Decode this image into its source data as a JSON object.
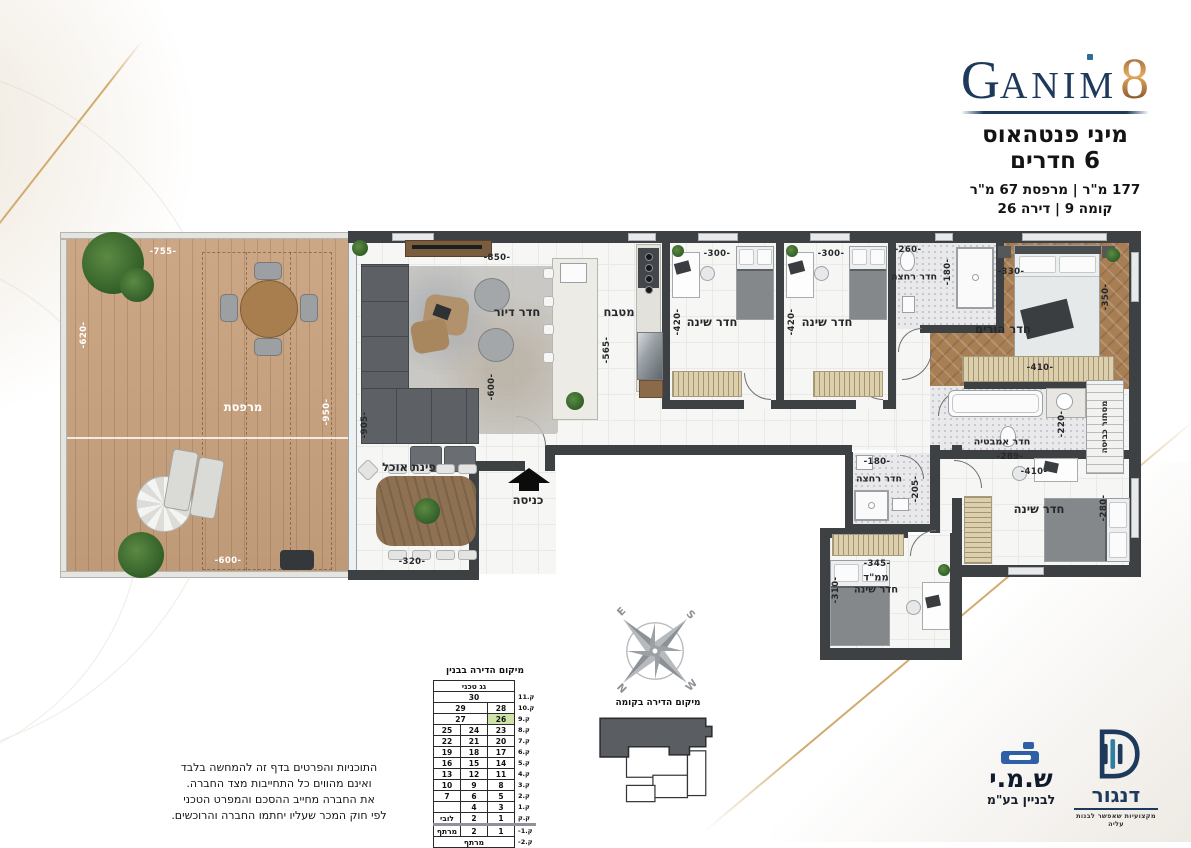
{
  "colors": {
    "brand_navy": "#1d3a5c",
    "brand_bronze": "#c08744",
    "accent_teal": "#2f6e94",
    "wall": "#3e4144",
    "deck_wood": "#c9a27e",
    "highlight_green": "#cfe3a9"
  },
  "header": {
    "brand_g": "G",
    "brand_rest": "ANIM",
    "brand_num": "8",
    "title_line1": "מיני פנטהאוס",
    "title_line2": "6 חדרים",
    "spec_line": "177 מ\"ר | מרפסת 67 מ\"ר",
    "floor_line": "קומה 9 | דירה 26"
  },
  "plan": {
    "labels": {
      "balcony": "מרפסת",
      "balcony_top": "-755-",
      "balcony_left": "-620-",
      "balcony_right": "-950-",
      "balcony_bottom": "-600-",
      "living": "חדר דיור",
      "living_top": "-850-",
      "living_right": "-905-",
      "living_mid": "-600-",
      "dining": "פינת אוכל",
      "dining_w": "-320-",
      "entrance": "כניסה",
      "kitchen": "מטבח",
      "kitchen_h": "-565-",
      "bedroom1": "חדר שינה",
      "bedroom1_w": "-300-",
      "bedroom1_h": "-420-",
      "bedroom2": "חדר שינה",
      "bedroom2_w": "-300-",
      "bedroom2_h": "-420-",
      "bath_top": "חדר רחצה",
      "bath_top_w": "-260-",
      "bath_top_h": "-180-",
      "master": "חדר הורים",
      "master_w": "-330-",
      "master_h": "-350-",
      "master_wardrobe": "-410-",
      "master_bath": "חדר אמבטיה",
      "master_bath_w": "-289-",
      "master_bath_h": "-220-",
      "laundry": "מסתור כביסה",
      "bath2": "חדר רחצה",
      "bath2_w": "-180-",
      "bath2_h": "-205-",
      "bedroom3": "חדר שינה",
      "bedroom3_w": "-410-",
      "bedroom3_h": "-280-",
      "mamad1": "ממ\"ד",
      "mamad2": "חדר שינה",
      "mamad_w": "-345-",
      "mamad_h": "-310-"
    }
  },
  "location_table": {
    "title": "מיקום הדירה בבנין",
    "floors": [
      {
        "label": "",
        "cells": [
          {
            "t": "גג טכני",
            "span": 3
          }
        ]
      },
      {
        "label": "11.ק",
        "cells": [
          {
            "t": "30",
            "span": 3
          }
        ]
      },
      {
        "label": "10.ק",
        "cells": [
          {
            "t": "29",
            "span": 2
          },
          {
            "t": "28"
          }
        ]
      },
      {
        "label": "9.ק",
        "cells": [
          {
            "t": "27",
            "span": 2
          },
          {
            "t": "26",
            "hl": true
          }
        ]
      },
      {
        "label": "8.ק",
        "cells": [
          {
            "t": "25"
          },
          {
            "t": "24"
          },
          {
            "t": "23"
          }
        ]
      },
      {
        "label": "7.ק",
        "cells": [
          {
            "t": "22"
          },
          {
            "t": "21"
          },
          {
            "t": "20"
          }
        ]
      },
      {
        "label": "6.ק",
        "cells": [
          {
            "t": "19"
          },
          {
            "t": "18"
          },
          {
            "t": "17"
          }
        ]
      },
      {
        "label": "5.ק",
        "cells": [
          {
            "t": "16"
          },
          {
            "t": "15"
          },
          {
            "t": "14"
          }
        ]
      },
      {
        "label": "4.ק",
        "cells": [
          {
            "t": "13"
          },
          {
            "t": "12"
          },
          {
            "t": "11"
          }
        ]
      },
      {
        "label": "3.ק",
        "cells": [
          {
            "t": "10"
          },
          {
            "t": "9"
          },
          {
            "t": "8"
          }
        ]
      },
      {
        "label": "2.ק",
        "cells": [
          {
            "t": "7"
          },
          {
            "t": "6"
          },
          {
            "t": "5"
          }
        ]
      },
      {
        "label": "1.ק",
        "cells": [
          {
            "t": ""
          },
          {
            "t": "4"
          },
          {
            "t": "3"
          }
        ]
      },
      {
        "label": "ק.ק",
        "cells": [
          {
            "t": "לובי"
          },
          {
            "t": "2"
          },
          {
            "t": "1"
          }
        ]
      },
      {
        "label": "-1.ק",
        "cells": [
          {
            "t": "מרתף"
          },
          {
            "t": "2"
          },
          {
            "t": "1"
          }
        ],
        "ground": true
      },
      {
        "label": "-2.ק",
        "cells": [
          {
            "t": "מרתף",
            "span": 3
          }
        ]
      }
    ]
  },
  "compass": {
    "nw": "E",
    "ne": "S",
    "sw": "N",
    "se": "W"
  },
  "floor_diagram": {
    "title": "מיקום הדירה בקומה"
  },
  "disclaimer": [
    "התוכניות והפרטים בדף זה להמחשה בלבד",
    "ואינם מהווים כל התחייבות מצד החברה.",
    "את החברה מחייב ההסכם והמפרט הטכני",
    "לפי חוק המכר שעליו יחתמו החברה והרוכשים."
  ],
  "logos": {
    "shmi_name": "ש.מ.י",
    "shmi_sub": "לבניין בע\"מ",
    "dangor_name": "דנגור",
    "dangor_tagline": "מקצועיות שאפשר לבנות עליה"
  }
}
